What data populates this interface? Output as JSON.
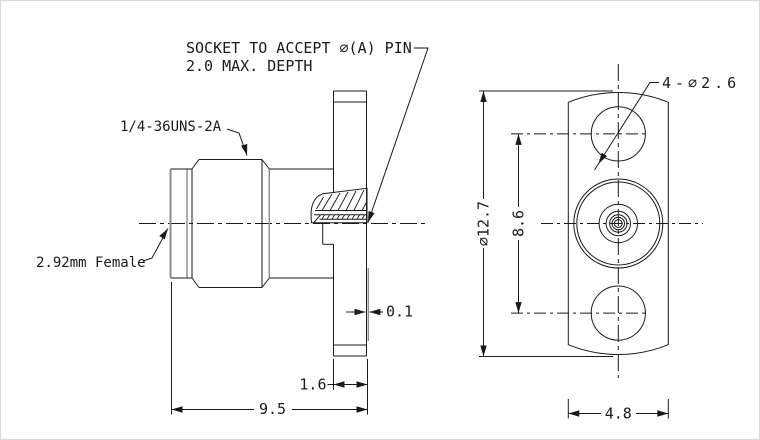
{
  "drawing": {
    "annotations": {
      "socket_note_line1": "SOCKET TO ACCEPT ∅(A) PIN",
      "socket_note_line2": "2.0 MAX. DEPTH",
      "thread_spec": "1/4-36UNS-2A",
      "connector_type": "2.92mm Female",
      "hole_callout": "4-∅2.6"
    },
    "dimensions": {
      "face_offset": "0.1",
      "flange_thickness": "1.6",
      "overall_length": "9.5",
      "flange_width": "4.8",
      "hole_spacing": "8.6",
      "flange_diameter": "∅12.7"
    },
    "colors": {
      "line": "#1a1a1a",
      "background": "#ffffff"
    }
  }
}
